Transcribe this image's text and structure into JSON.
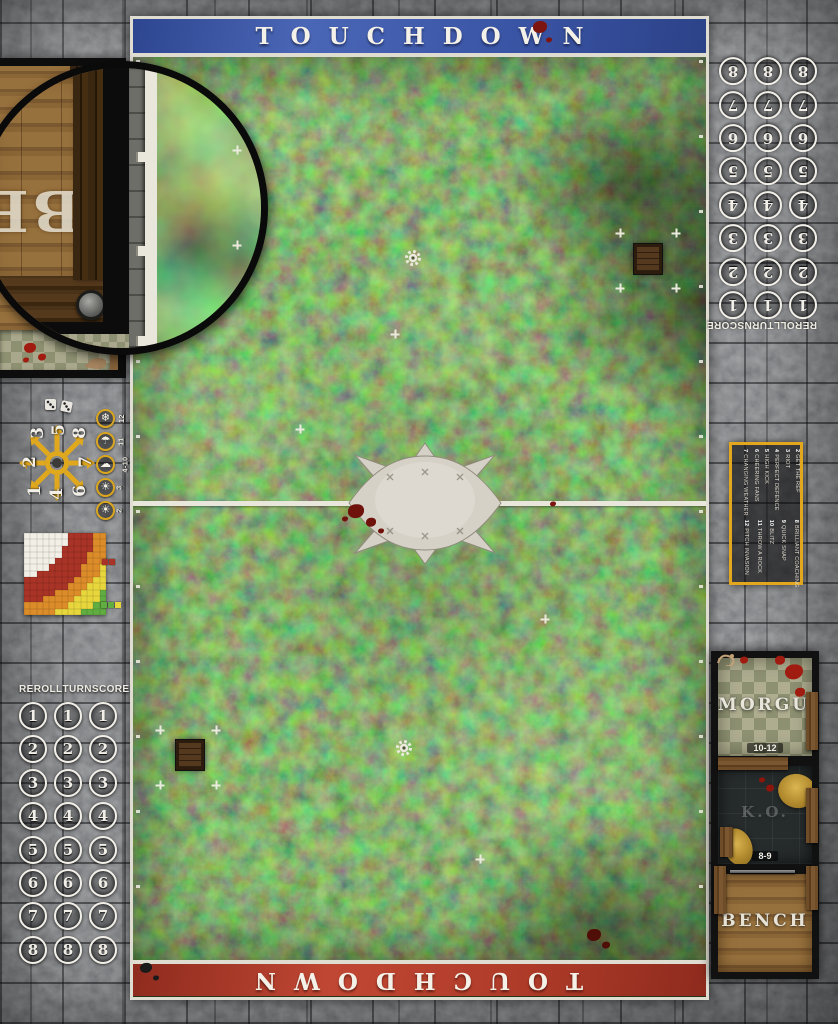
{
  "banners": {
    "top": {
      "text": "TOUCHDOWN",
      "color": "#3b55a6"
    },
    "bottom": {
      "text": "TOUCHDOWN",
      "color": "#ad3a28"
    }
  },
  "tracks": {
    "headers": [
      "REROLL",
      "TURN",
      "SCORE"
    ],
    "numbers": [
      "1",
      "2",
      "3",
      "4",
      "5",
      "6",
      "7",
      "8"
    ],
    "columns_per_number": 3
  },
  "inset": {
    "magnified_text": "BE"
  },
  "scatter": {
    "cells": [
      {
        "n": "3",
        "x": 38,
        "y": 433
      },
      {
        "n": "5",
        "x": 59,
        "y": 430
      },
      {
        "n": "8",
        "x": 80,
        "y": 433
      },
      {
        "n": "2",
        "x": 30,
        "y": 462
      },
      {
        "n": "7",
        "x": 86,
        "y": 462
      },
      {
        "n": "1",
        "x": 35,
        "y": 491
      },
      {
        "n": "4",
        "x": 57,
        "y": 494
      },
      {
        "n": "6",
        "x": 80,
        "y": 491
      }
    ],
    "arrow_color": "#e0a81d"
  },
  "weather": {
    "items": [
      {
        "roll": "12",
        "icon": "snow-icon",
        "glyph": "❄"
      },
      {
        "roll": "11",
        "icon": "rain-icon",
        "glyph": "☂"
      },
      {
        "roll": "4-10",
        "icon": "cloud-icon",
        "glyph": "☁"
      },
      {
        "roll": "3",
        "icon": "sun-icon",
        "glyph": "☀"
      },
      {
        "roll": "2",
        "icon": "sun-icon",
        "glyph": "☀"
      }
    ],
    "ring_color": "#d9a51f"
  },
  "pass_chart": {
    "type": "heatmap",
    "cols": 13,
    "rows": 13,
    "cell": 6.3,
    "bands": [
      {
        "name": "quick-pass",
        "color": "#f2efe6",
        "max": 6.8
      },
      {
        "name": "short-pass",
        "color": "#a93327",
        "max": 10.8
      },
      {
        "name": "long-pass",
        "color": "#dd8c2a",
        "max": 13.4
      },
      {
        "name": "long-bomb",
        "color": "#e8d73c",
        "max": 15.6
      },
      {
        "name": "out-of-range",
        "color": "#61ad41",
        "max": 99
      }
    ],
    "legend_top": [
      "#a93327",
      "#a93327"
    ],
    "legend_bottom": [
      "#61ad41",
      "#61ad41",
      "#e8d73c"
    ]
  },
  "kickoff": {
    "border_color": "#e2a71e",
    "rows": [
      {
        "roll": "2",
        "event": "GET THE REF"
      },
      {
        "roll": "3",
        "event": "RIOT"
      },
      {
        "roll": "4",
        "event": "PERFECT DEFENCE"
      },
      {
        "roll": "5",
        "event": "HIGH KICK"
      },
      {
        "roll": "6",
        "event": "CHEERING FANS"
      },
      {
        "roll": "7",
        "event": "CHANGING WEATHER"
      },
      {
        "roll": "8",
        "event": "BRILLIANT COACHING"
      },
      {
        "roll": "9",
        "event": "QUICK SNAP"
      },
      {
        "roll": "10",
        "event": "BLITZ"
      },
      {
        "roll": "11",
        "event": "THROW A ROCK"
      },
      {
        "roll": "12",
        "event": "PITCH INVASION"
      }
    ]
  },
  "dugout_right": {
    "sections": [
      {
        "label": "MORGUE",
        "range": "10-12"
      },
      {
        "label": "K.O.",
        "range": "8-9"
      },
      {
        "label": "BENCH",
        "range": ""
      }
    ]
  },
  "markers": {
    "trapdoors": [
      [
        634,
        245
      ],
      [
        176,
        741
      ]
    ],
    "gears": [
      [
        413,
        259
      ],
      [
        404,
        749
      ]
    ],
    "crosses": [
      [
        160,
        731
      ],
      [
        216,
        731
      ],
      [
        160,
        786
      ],
      [
        216,
        786
      ],
      [
        620,
        234
      ],
      [
        676,
        234
      ],
      [
        620,
        289
      ],
      [
        676,
        289
      ],
      [
        300,
        430
      ],
      [
        545,
        620
      ],
      [
        395,
        335
      ],
      [
        480,
        860
      ]
    ]
  },
  "decor": {
    "blood": [
      {
        "x": 540,
        "y": 27,
        "r": 7,
        "c": "#7c1410"
      },
      {
        "x": 549,
        "y": 40,
        "r": 3,
        "c": "#7c1410"
      },
      {
        "x": 356,
        "y": 512,
        "r": 8,
        "c": "#6e120b"
      },
      {
        "x": 371,
        "y": 523,
        "r": 5,
        "c": "#6e120b"
      },
      {
        "x": 381,
        "y": 532,
        "r": 3,
        "c": "#6e120b"
      },
      {
        "x": 345,
        "y": 520,
        "r": 3,
        "c": "#6e120b"
      },
      {
        "x": 553,
        "y": 505,
        "r": 3,
        "c": "#7c1410"
      },
      {
        "x": 594,
        "y": 936,
        "r": 7,
        "c": "#4f0e08"
      },
      {
        "x": 606,
        "y": 946,
        "r": 4,
        "c": "#4f0e08"
      },
      {
        "x": 146,
        "y": 968,
        "r": 6,
        "c": "#1a1a1a"
      },
      {
        "x": 156,
        "y": 978,
        "r": 3,
        "c": "#1a1a1a"
      },
      {
        "x": 794,
        "y": 672,
        "r": 9,
        "c": "#a01c10"
      },
      {
        "x": 780,
        "y": 660,
        "r": 5,
        "c": "#a01c10"
      },
      {
        "x": 800,
        "y": 692,
        "r": 5,
        "c": "#a01c10"
      },
      {
        "x": 744,
        "y": 660,
        "r": 4,
        "c": "#a01c10"
      },
      {
        "x": 770,
        "y": 788,
        "r": 4,
        "c": "#8c150c"
      },
      {
        "x": 762,
        "y": 780,
        "r": 3,
        "c": "#8c150c"
      },
      {
        "x": 30,
        "y": 348,
        "r": 6,
        "c": "#a01c10"
      },
      {
        "x": 42,
        "y": 357,
        "r": 4,
        "c": "#a01c10"
      },
      {
        "x": 26,
        "y": 360,
        "r": 3,
        "c": "#a01c10"
      }
    ]
  }
}
